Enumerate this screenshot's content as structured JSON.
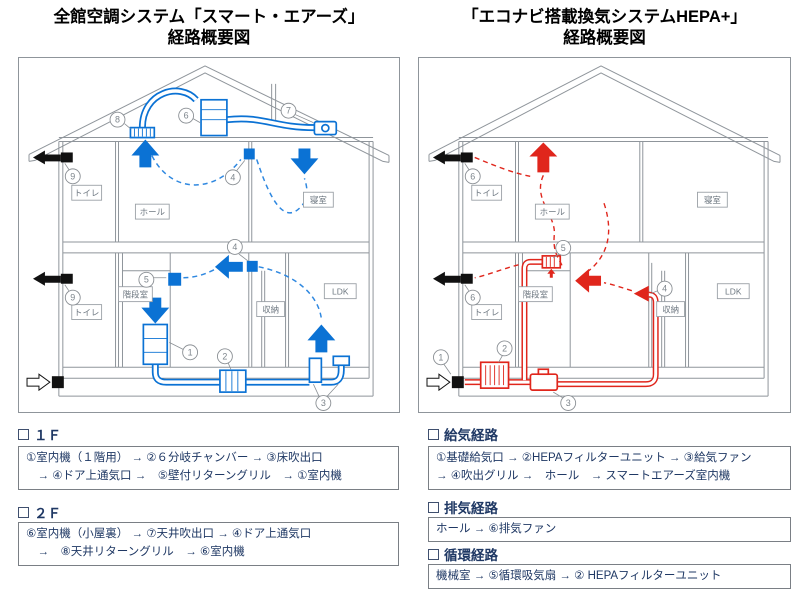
{
  "colors": {
    "blue": "#0b72d4",
    "red": "#e0261c",
    "navy": "#1f3864"
  },
  "titles": {
    "left": {
      "line1": "全館空調システム「スマート・エアーズ」",
      "line2": "経路概要図"
    },
    "right": {
      "line1": "「エコナビ搭載換気システムHEPA+」",
      "line2": "経路概要図"
    }
  },
  "rooms": {
    "toilet_2f": "トイレ",
    "hall": "ホール",
    "bedroom": "寝室",
    "toilet_1f": "トイレ",
    "stairs": "階段室",
    "closet": "収納",
    "ldk": "LDK"
  },
  "markers": {
    "n1": "1",
    "n2": "2",
    "n3": "3",
    "n4": "4",
    "n5": "5",
    "n6": "6",
    "n7": "7",
    "n8": "8",
    "n9": "9"
  },
  "left_sections": [
    {
      "heading": "１Ｆ",
      "lines": [
        "①室内機（１階用） → ②６分岐チャンバー → ③床吹出口",
        "　→ ④ドア上通気口 →　⑤壁付リターングリル　→ ①室内機"
      ]
    },
    {
      "heading": "２Ｆ",
      "lines": [
        "⑥室内機（小屋裏） → ⑦天井吹出口 → ④ドア上通気口",
        "　→　⑧天井リターングリル　→ ⑥室内機"
      ]
    }
  ],
  "right_sections": [
    {
      "heading": "給気経路",
      "lines": [
        "①基礎給気口 → ②HEPAフィルターユニット → ③給気ファン",
        "→ ④吹出グリル →　ホール　→ スマートエアーズ室内機"
      ]
    },
    {
      "heading": "排気経路",
      "lines": [
        "ホール → ⑥排気ファン"
      ]
    },
    {
      "heading": "循環経路",
      "lines": [
        "機械室 → ⑤循環吸気扇 → ② HEPAフィルターユニット"
      ]
    }
  ]
}
